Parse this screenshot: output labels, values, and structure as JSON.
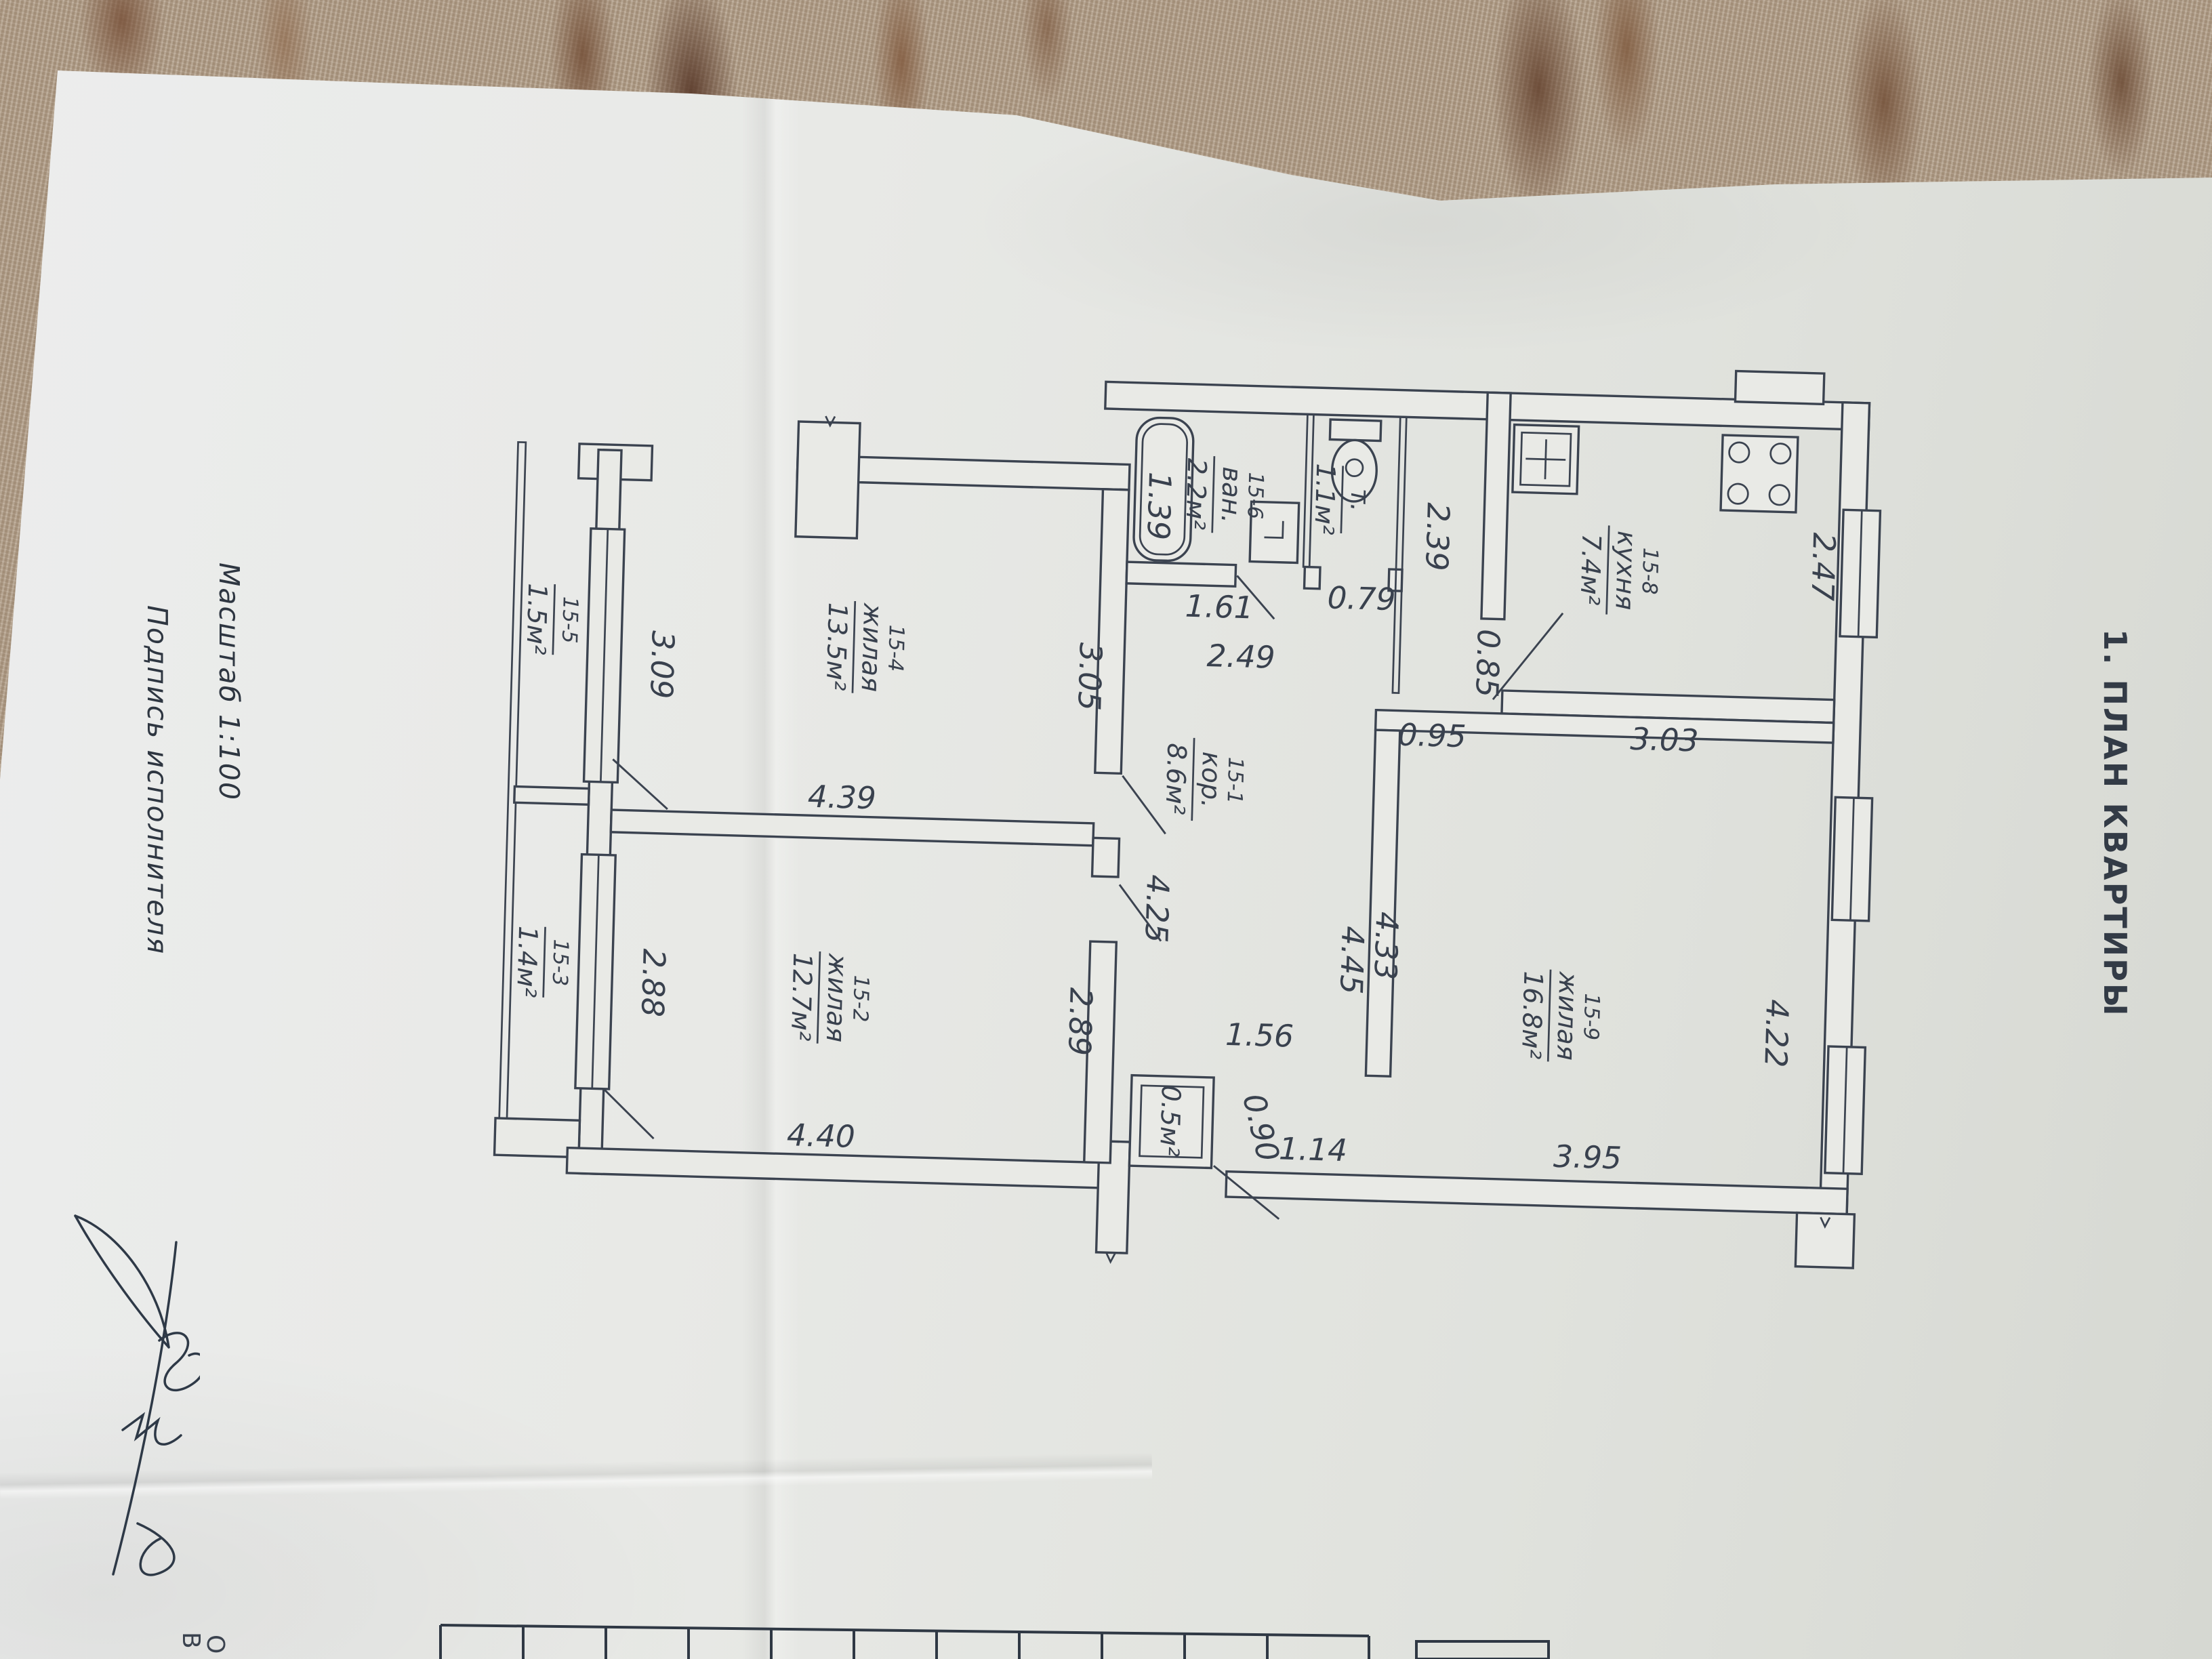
{
  "document": {
    "title": "1. ПЛАН КВАРТИРЫ",
    "scale": "Масштаб  1:100",
    "signature_caption": "Подпись исполнителя",
    "letters": {
      "b": "В",
      "o": "О"
    }
  },
  "rooms": {
    "corridor": {
      "id": "15-1",
      "name": "кор.",
      "area": "8.6м²"
    },
    "living2": {
      "id": "15-2",
      "name": "жилая",
      "area": "12.7м²"
    },
    "balcony3": {
      "id": "15-3",
      "area": "1.4м²"
    },
    "living4": {
      "id": "15-4",
      "name": "жилая",
      "area": "13.5м²"
    },
    "balcony5": {
      "id": "15-5",
      "area": "1.5м²"
    },
    "bath": {
      "id": "15-6",
      "name": "ван.",
      "area": "2.2м²"
    },
    "wc": {
      "name": "т.",
      "area": "1.1м²"
    },
    "kitchen": {
      "id": "15-8",
      "name": "кухня",
      "area": "7.4м²"
    },
    "living9": {
      "id": "15-9",
      "name": "жилая",
      "area": "16.8м²"
    },
    "closet": {
      "area": "0.5м²"
    }
  },
  "dims": {
    "kitchen_width": "3.03",
    "kitchen_depth": "2.47",
    "wc_wall": "2.39",
    "wc_width": "0.79",
    "bath_width": "1.61",
    "bath_depth": "1.39",
    "bath_front": "2.49",
    "entry_width": "0.95",
    "entry_door": "0.85",
    "living4_width": "4.39",
    "living4_depth": "3.05",
    "balcony5_length": "3.09",
    "living2_width": "4.40",
    "living2_depth": "2.89",
    "balcony3_length": "2.88",
    "corridor_left": "4.25",
    "corridor_right_a": "4.45",
    "corridor_right_b": "4.33",
    "living9_depth": "4.22",
    "living9_width": "3.95",
    "closet_front": "1.56",
    "closet_door": "0.90",
    "closet_side": "1.14"
  },
  "colors": {
    "ink": "#3b4350",
    "paper": "#e8e9e6",
    "carpet": "#b5a28c",
    "carpet_accent": "#7b563f"
  }
}
